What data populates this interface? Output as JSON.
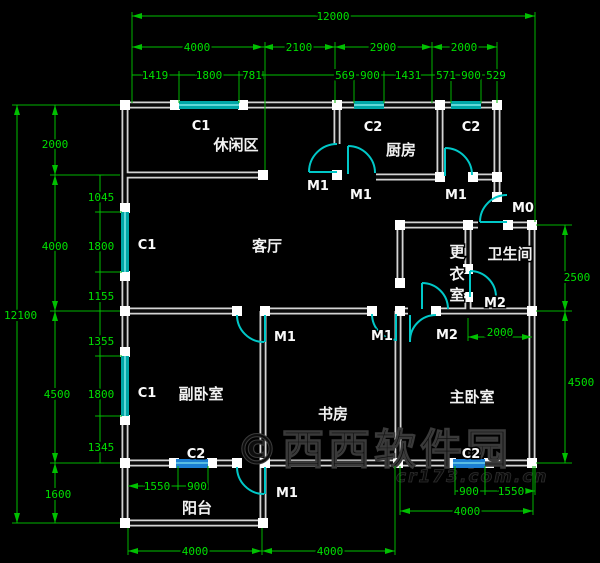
{
  "drawing_type": "apartment floor plan (CAD)",
  "colors": {
    "background": "#000000",
    "dimension_line": "#00b400",
    "dimension_text": "#00e000",
    "wall": "#d4d4d4",
    "wall_cap": "#ffffff",
    "window_teal": "#00a6a6",
    "window_blue": "#1c7fd4",
    "door_cyan": "#00c8c8",
    "room_label": "#f2f2f2",
    "watermark": "#1a1a1a"
  },
  "rooms": [
    {
      "name": "leisure-area",
      "label": "休闲区"
    },
    {
      "name": "kitchen",
      "label": "厨房"
    },
    {
      "name": "living-room",
      "label": "客厅"
    },
    {
      "name": "dressing-room",
      "label": "更衣室",
      "chars": [
        "更",
        "衣",
        "室"
      ]
    },
    {
      "name": "bathroom",
      "label": "卫生间"
    },
    {
      "name": "second-bedroom",
      "label": "副卧室"
    },
    {
      "name": "study",
      "label": "书房"
    },
    {
      "name": "master-bedroom",
      "label": "主卧室"
    },
    {
      "name": "balcony",
      "label": "阳台"
    }
  ],
  "windows": {
    "labels": [
      "C1",
      "C2",
      "C2",
      "C1",
      "C1",
      "C2",
      "C2"
    ]
  },
  "doors": {
    "labels": [
      "M1",
      "M1",
      "M1",
      "M0",
      "M1",
      "M1",
      "M2",
      "M2",
      "M1"
    ]
  },
  "dims": {
    "top_total": "12000",
    "top_row2": [
      "4000",
      "2100",
      "2900",
      "2000"
    ],
    "top_row3": [
      "1419",
      "1800",
      "781",
      "569",
      "900",
      "1431",
      "571",
      "900",
      "529"
    ],
    "left_total": "12100",
    "left_col": [
      "2000",
      "4000",
      "4500",
      "1600"
    ],
    "left_sub": [
      "1045",
      "1800",
      "1155",
      "1355",
      "1800",
      "1345"
    ],
    "right_col": [
      "2500",
      "4500"
    ],
    "bath_width": "2000",
    "bottom_row": [
      "4000",
      "4000"
    ],
    "master_width": "4000",
    "balcony_sub": [
      "1550",
      "900"
    ],
    "master_sub": [
      "900",
      "1550"
    ]
  },
  "watermark": {
    "text": "©西西软件园",
    "domain": "cr173.com.cn"
  }
}
